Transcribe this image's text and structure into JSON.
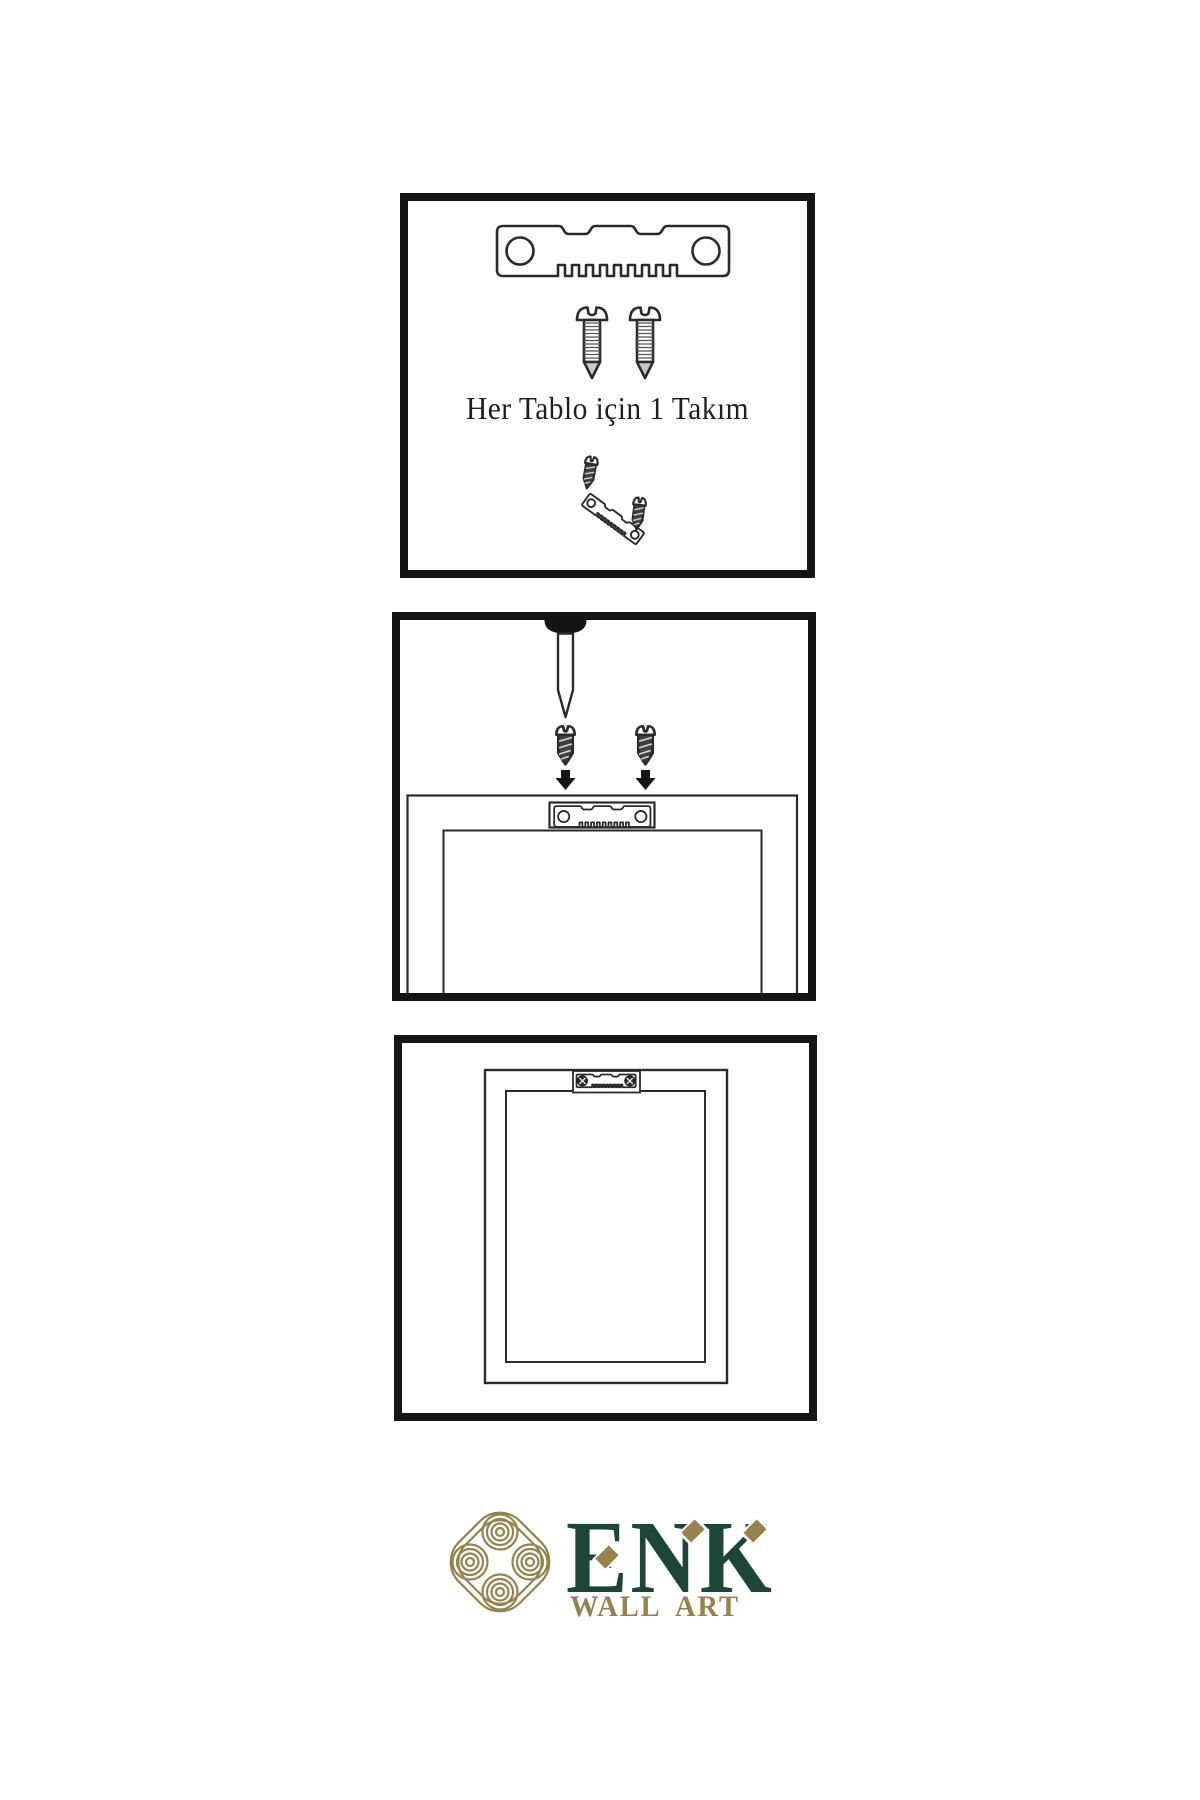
{
  "step1": {
    "caption": "Her Tablo için 1 Takım",
    "icons": [
      "sawtooth-hanger-icon",
      "screw-icon",
      "screw-into-hanger-icon"
    ]
  },
  "step2": {
    "icons": [
      "wall-nail-icon",
      "screw-icon",
      "arrow-down-icon",
      "sawtooth-hanger-icon",
      "frame-back-icon"
    ]
  },
  "step3": {
    "icons": [
      "framed-picture-icon",
      "mounted-sawtooth-hanger-icon"
    ]
  },
  "logo": {
    "brand": "ENK",
    "tagline": "WALL ART",
    "icons": [
      "knot-monogram-icon",
      "diamond-accent-icon"
    ],
    "colors": {
      "green": "#1b4638",
      "gold": "#97824d"
    }
  },
  "colors": {
    "paper": "#ffffff",
    "ink": "#2b2b2b",
    "panel_border": "#151515"
  }
}
